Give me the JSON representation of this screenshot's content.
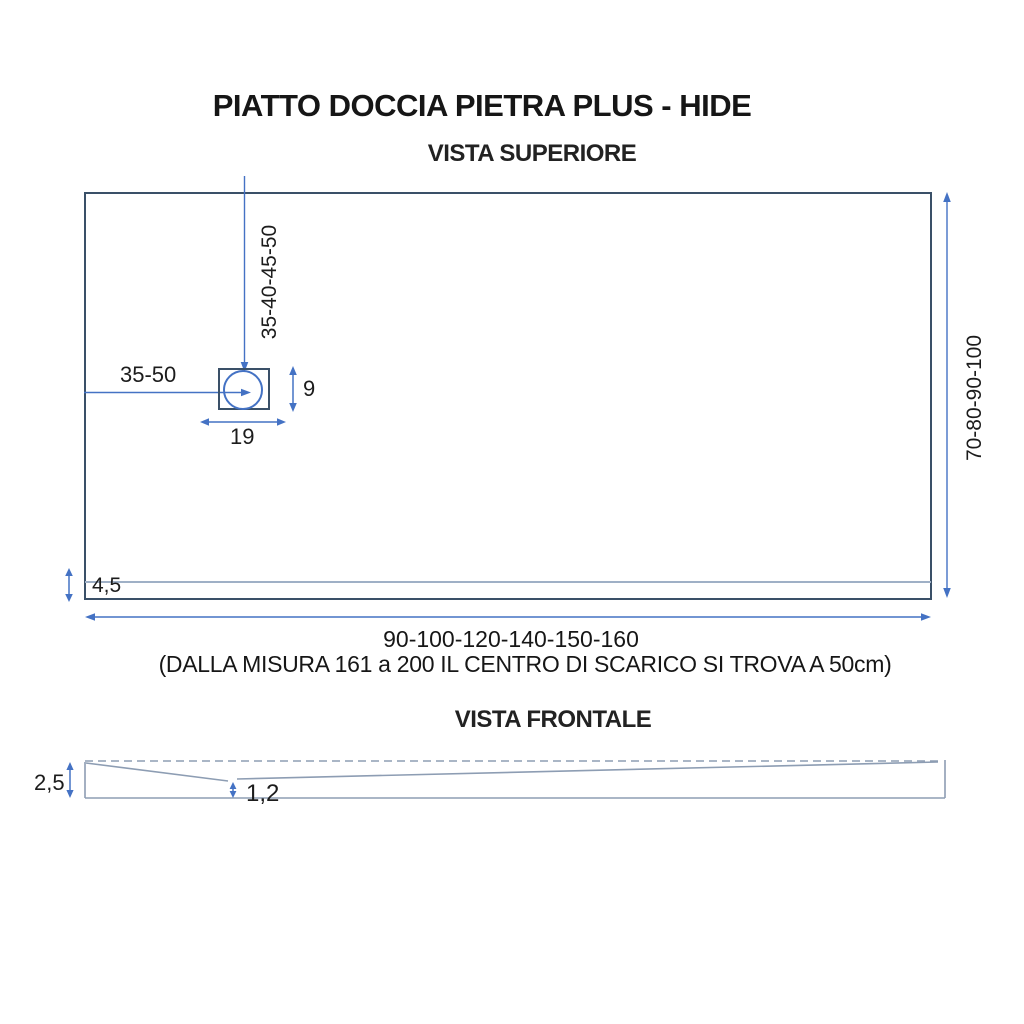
{
  "title": "PIATTO DOCCIA PIETRA PLUS - HIDE",
  "top_view": {
    "label": "VISTA SUPERIORE",
    "drain_offset_from_top": "35-40-45-50",
    "drain_offset_from_left": "35-50",
    "drain_height": "9",
    "drain_width": "19",
    "border_strip_height": "4,5",
    "tray_depth_options": "70-80-90-100",
    "tray_width_options": "90-100-120-140-150-160",
    "note": "(DALLA MISURA 161 a 200 IL CENTRO DI SCARICO SI TROVA A 50cm)"
  },
  "front_view": {
    "label": "VISTA FRONTALE",
    "edge_height": "2,5",
    "drain_recess_depth": "1,2"
  },
  "colors": {
    "outline_dark": "#3a5068",
    "dimension_blue": "#4472C4",
    "light_line": "#9fb0c6",
    "front_outline": "#8d9db3",
    "text": "#1c1c1c"
  }
}
